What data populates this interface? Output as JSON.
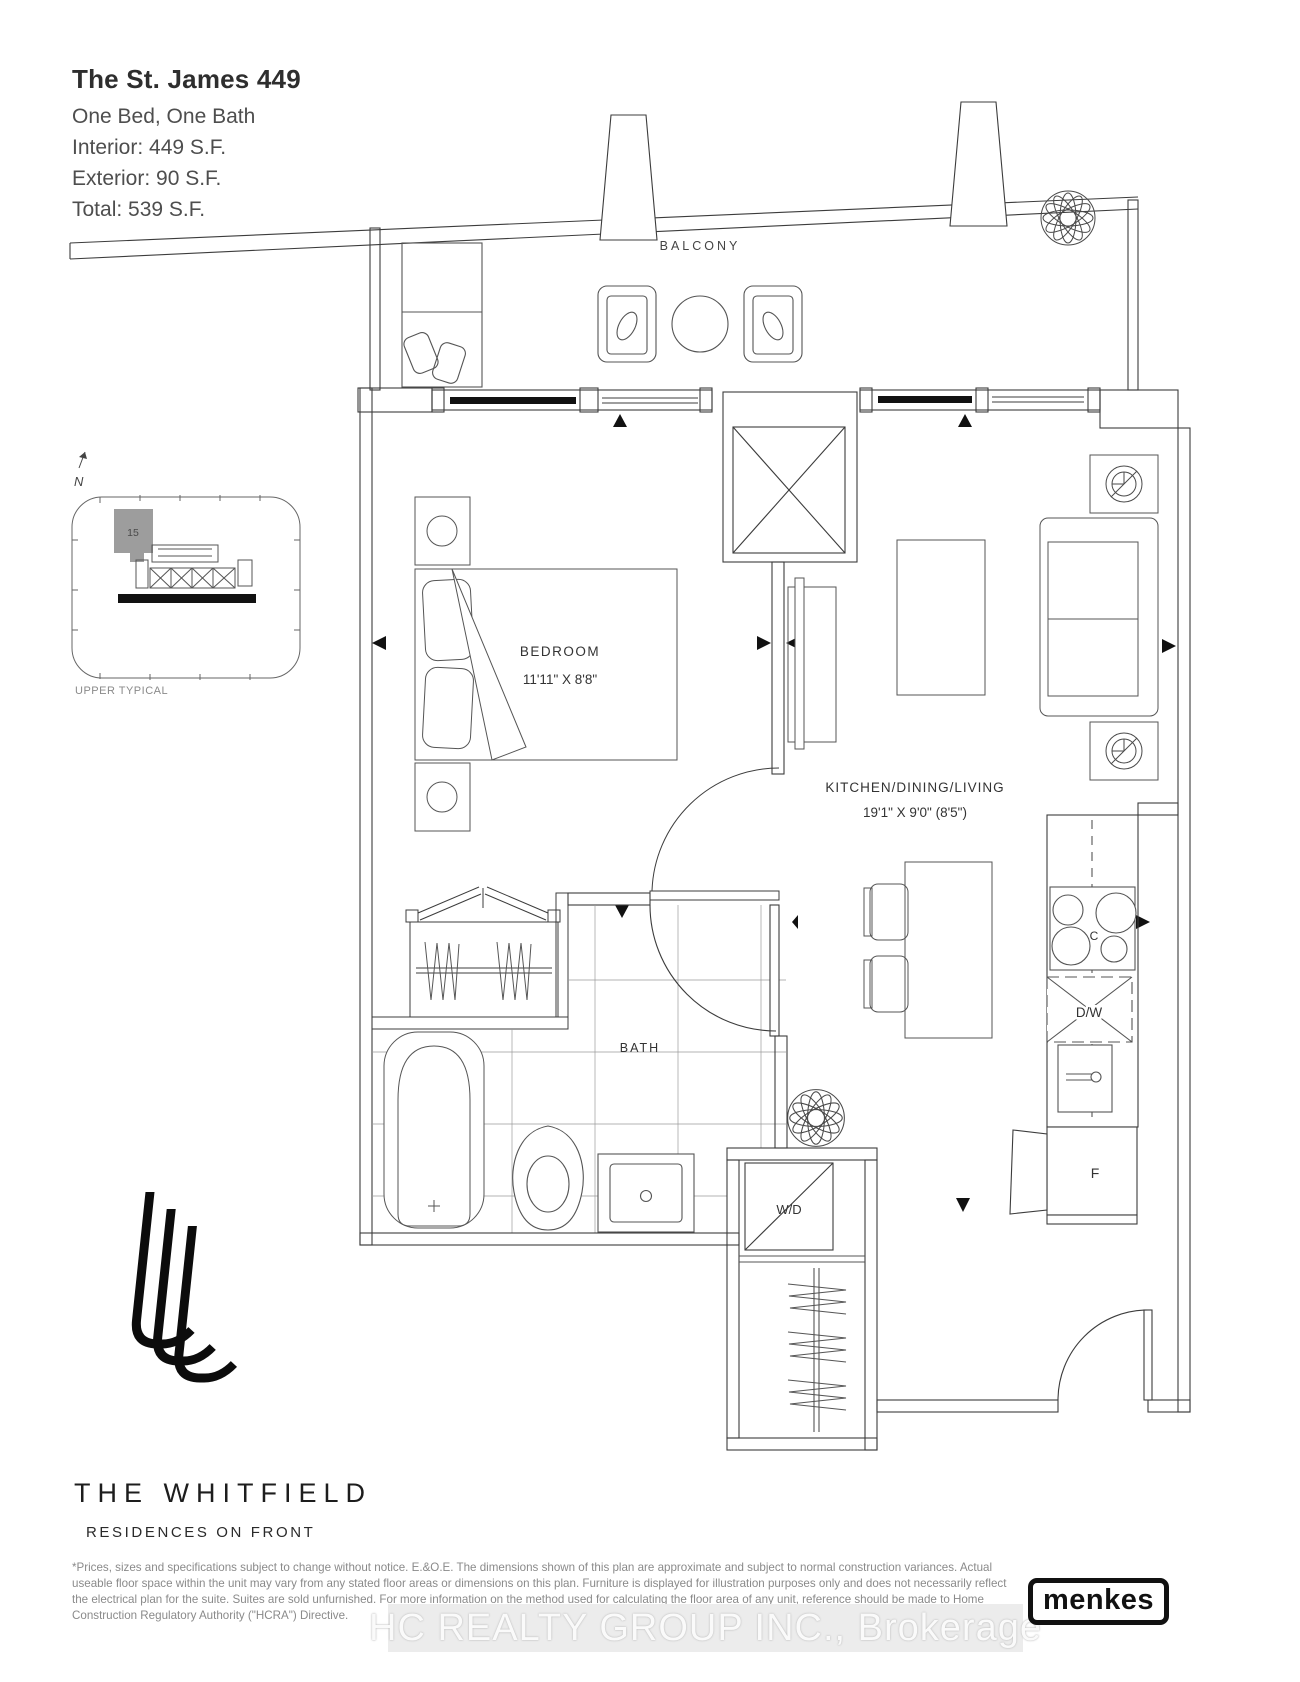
{
  "title_block": {
    "title": "The St. James 449",
    "subtitle": "One Bed, One Bath",
    "interior": "Interior: 449 S.F.",
    "exterior": "Exterior: 90 S.F.",
    "total": "Total: 539 S.F."
  },
  "key_plan": {
    "north_label": "N",
    "unit_number": "15",
    "caption": "UPPER TYPICAL"
  },
  "plan_labels": {
    "balcony": "BALCONY",
    "bedroom": "BEDROOM",
    "bedroom_dims": "11'11\" X 8'8\"",
    "kitchen": "KITCHEN/DINING/LIVING",
    "kitchen_dims": "19'1\" X 9'0\" (8'5\")",
    "bath": "BATH",
    "washer_dryer": "W/D",
    "cooktop": "C",
    "dishwasher": "D/W",
    "fridge": "F"
  },
  "branding": {
    "brand_name": "THE WHITFIELD",
    "brand_tagline": "RESIDENCES ON FRONT",
    "builder_logo": "menkes"
  },
  "footer": {
    "disclaimer": "*Prices, sizes and specifications subject to change without notice. E.&O.E. The dimensions shown of this plan are approximate and subject to normal construction variances. Actual useable floor space within the unit may vary from any stated floor areas or dimensions on this plan. Furniture is displayed for illustration purposes only and does not necessarily reflect the electrical plan for the suite. Suites are sold unfurnished. For more information on the method used for calculating the floor area of any unit, reference should be made to Home Construction Regulatory Authority (\"HCRA\") Directive."
  },
  "watermark": {
    "text": "HC REALTY GROUP INC., Brokerage"
  },
  "icons": {
    "north-arrow-icon": "↑",
    "plant-icon": "✽",
    "lamp-icon": "◉",
    "section-marker-icon": "▲"
  },
  "colors": {
    "line": "#3c3c3c",
    "furniture_line": "#555555",
    "glazing": "#111111",
    "unit_highlight": "#9d9d9d",
    "watermark_band": "#ececec",
    "watermark_text": "#fafafa"
  }
}
